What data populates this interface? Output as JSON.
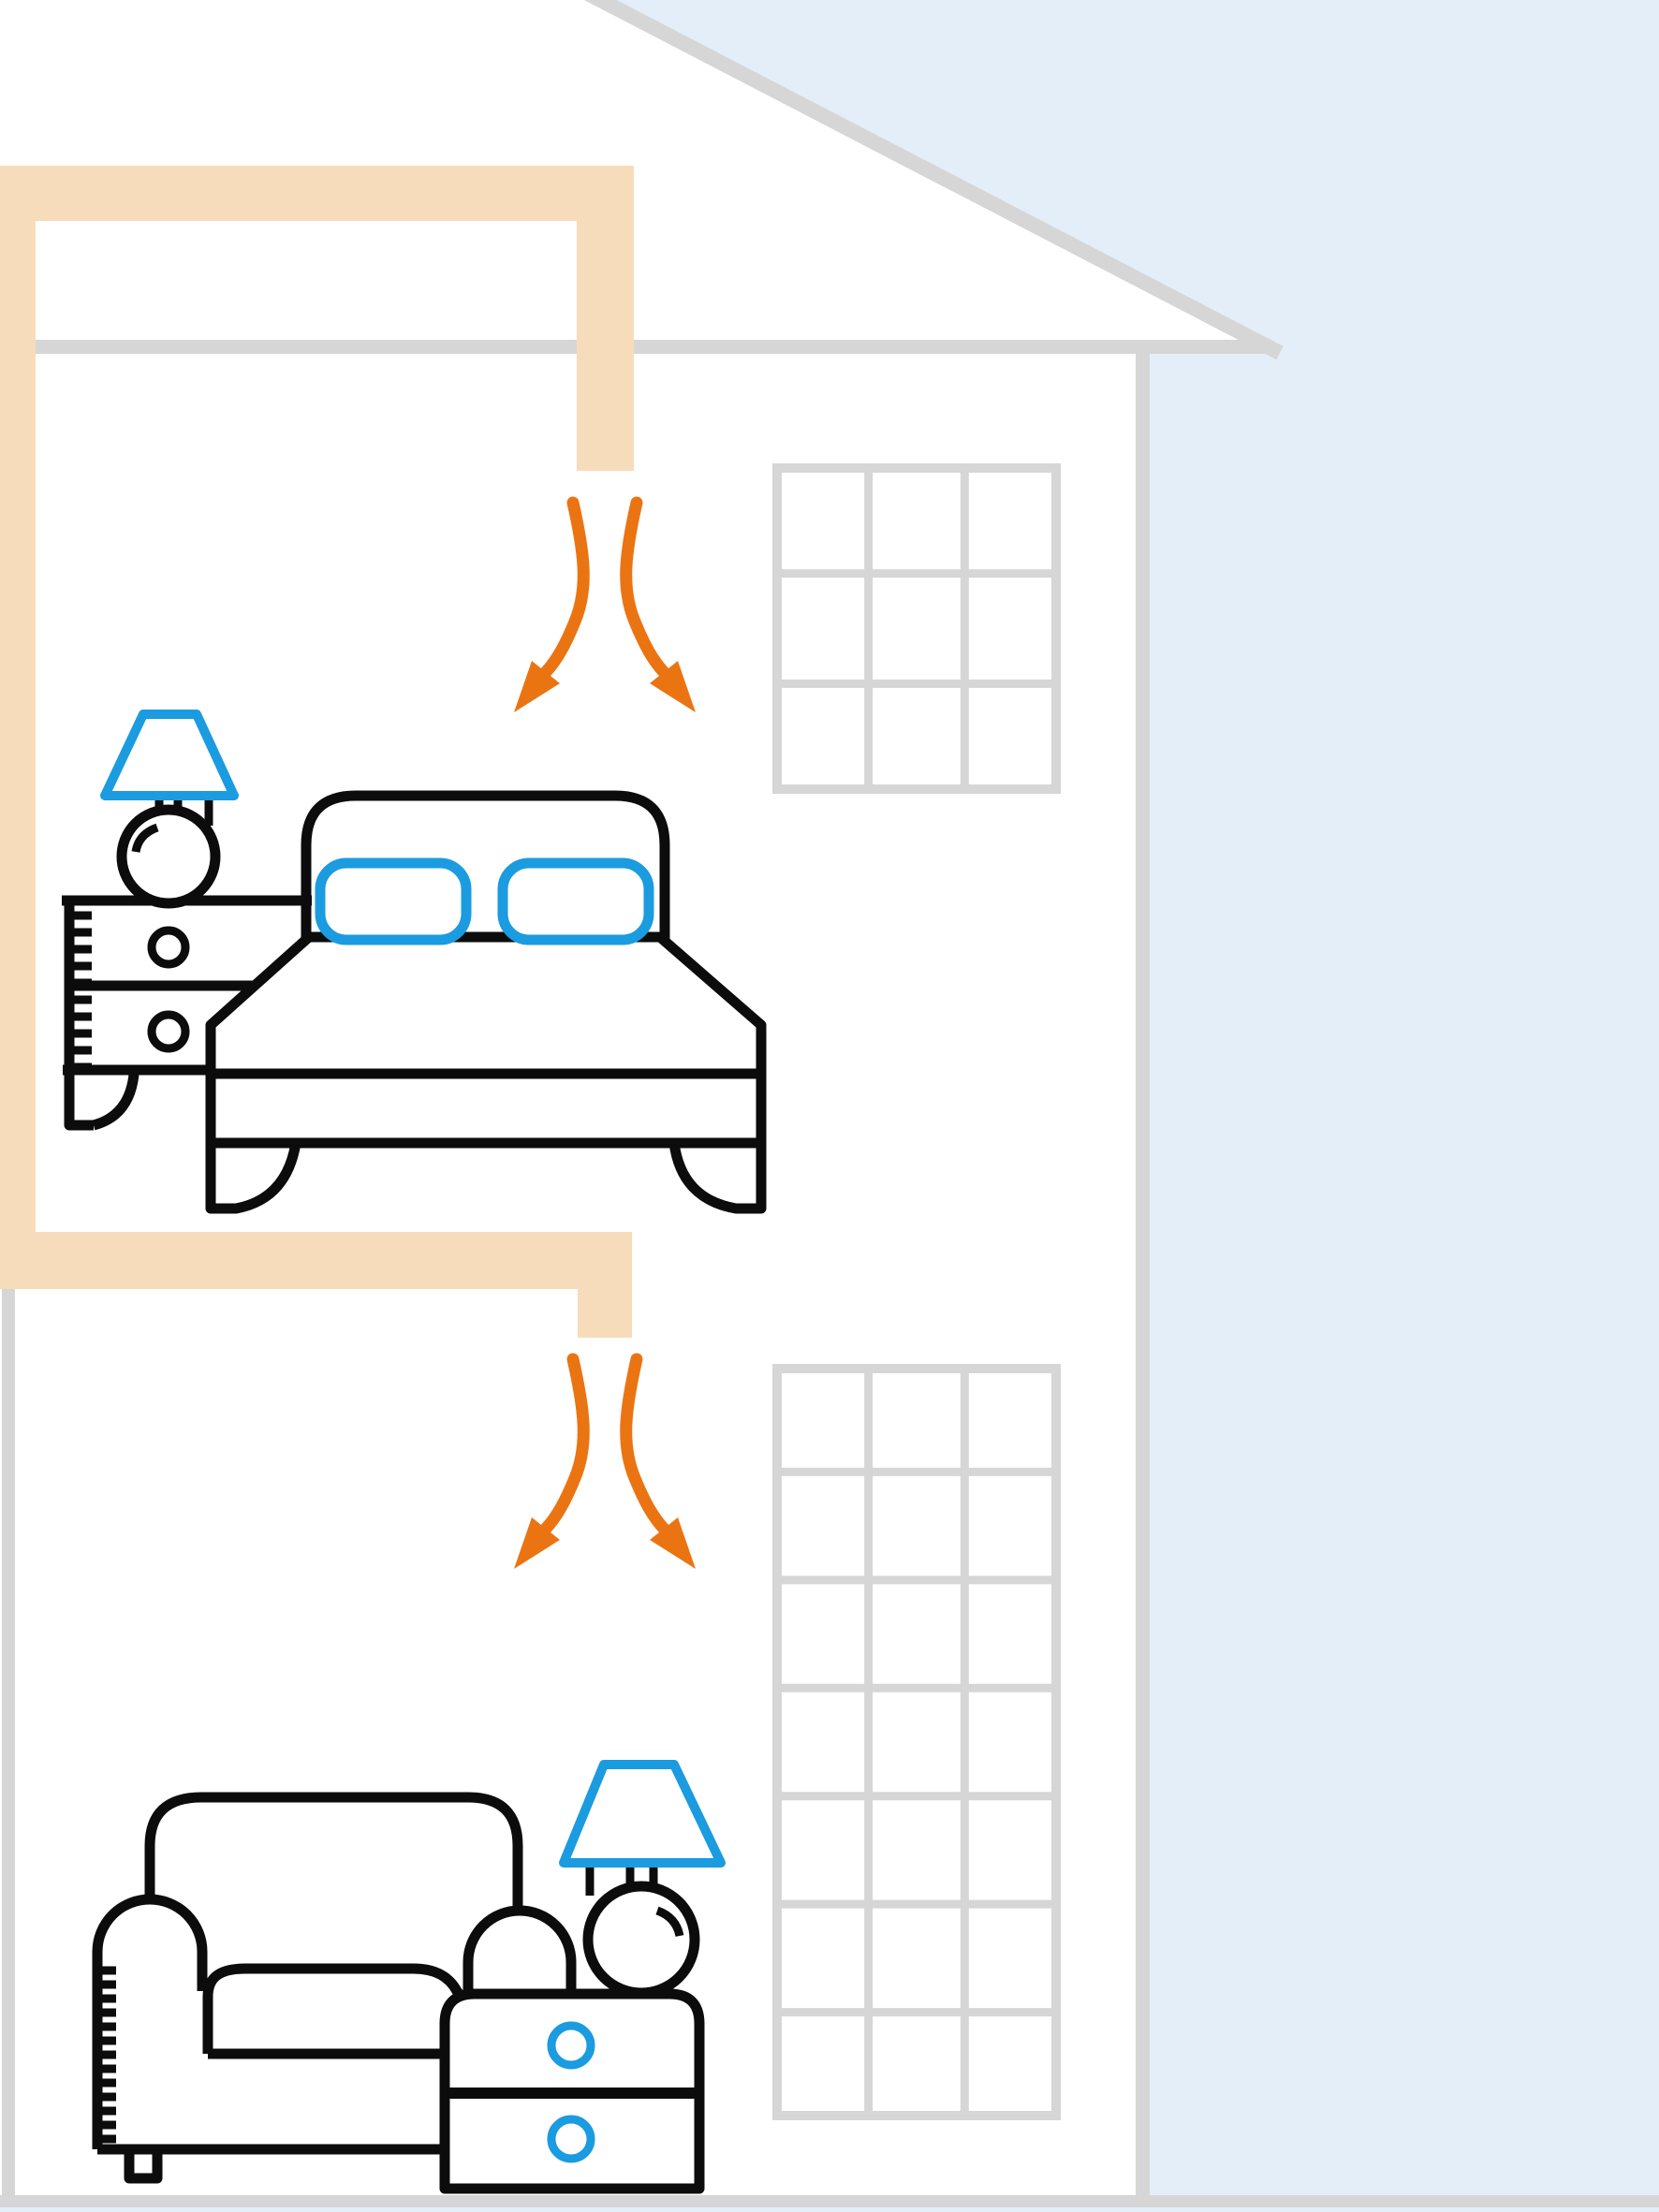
{
  "colors": {
    "ink": "#0C0C0C",
    "accent": "#1B9BE0",
    "arrow": "#EB7412",
    "duct": "#F7DCBB",
    "structure": "#D6D6D6",
    "sky": "#E4EEF8"
  },
  "windows": {
    "upper": {
      "cols": 3,
      "rows": 3
    },
    "lower": {
      "cols": 3,
      "rows": 7
    }
  },
  "scene": {
    "description": "Cross-section of a two-storey house: a warm-air heating duct runs from the attic down the left side and between floors, ending in ceiling vents that blow warm air (orange arrows) into a bedroom and a living room",
    "sky_position": "upper-right and right of house",
    "house": {
      "roof": "single pitched roof line, gray",
      "walls": [
        "left-lower",
        "right"
      ],
      "floor_levels": 2
    },
    "duct": {
      "color_key": "duct",
      "segments": [
        "attic-run",
        "left-riser",
        "upper-room-vent",
        "interfloor-run",
        "lower-room-vent"
      ]
    },
    "airflow": {
      "vents": 2,
      "arrows_per_vent": 2,
      "direction": "downward, spreading left and right"
    },
    "rooms": [
      {
        "name": "upper-bedroom",
        "furniture": [
          "table-lamp-blue-shade",
          "nightstand-two-drawers-black-knobs",
          "double-bed-with-two-blue-pillows"
        ]
      },
      {
        "name": "lower-living-room",
        "furniture": [
          "armchair",
          "table-lamp-blue-shade",
          "nightstand-two-drawers-blue-knobs"
        ]
      }
    ]
  }
}
